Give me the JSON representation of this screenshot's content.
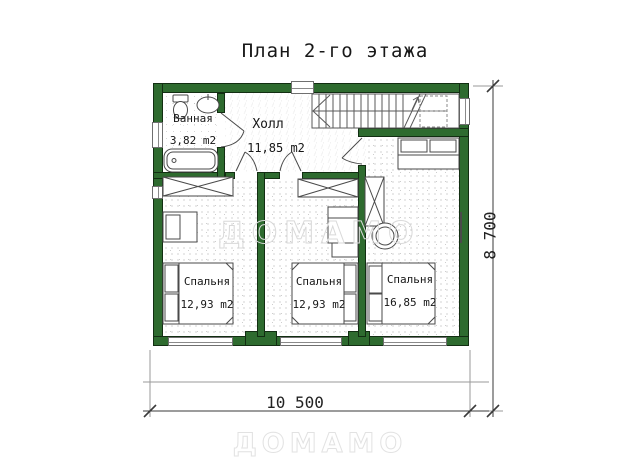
{
  "title": "План 2-го этажа",
  "rooms": {
    "bathroom": {
      "name": "Ванная",
      "area": "3,82 m2"
    },
    "hall": {
      "name": "Холл",
      "area": "11,85 m2"
    },
    "bedroom_left": {
      "name": "Спальня",
      "area": "12,93 m2"
    },
    "bedroom_middle": {
      "name": "Спальня",
      "area": "12,93 m2"
    },
    "bedroom_right": {
      "name": "Спальня",
      "area": "16,85 m2"
    }
  },
  "dimensions": {
    "width_label": "10 500",
    "height_label": "8 700"
  },
  "watermarks": {
    "center": "ДОМАМО",
    "footer": "ДОМАМО"
  },
  "colors": {
    "wall_green": "#2e6b2f",
    "line": "#555555",
    "watermark_gray": "#d9d9d9"
  }
}
